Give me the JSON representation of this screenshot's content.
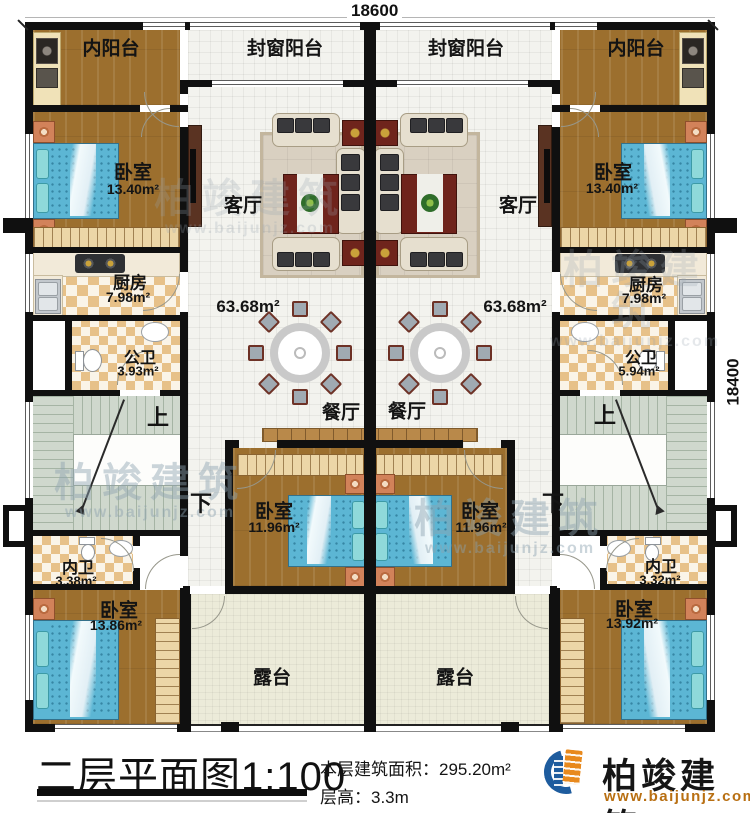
{
  "colors": {
    "wall": "#101010",
    "logo_blue": "#1e5c9e",
    "logo_orange": "#e8891d",
    "url_orange": "#b86f12",
    "bed_blue": "#5cb6d4"
  },
  "dimensions": {
    "top": "18600",
    "right": "18400"
  },
  "left_unit": {
    "inner_balcony": "内阳台",
    "sealed_balcony": "封窗阳台",
    "bedroom_top": {
      "name": "卧室",
      "area": "13.40m²"
    },
    "living": "客厅",
    "kitchen": {
      "name": "厨房",
      "area": "7.98m²"
    },
    "public_bath": {
      "name": "公卫",
      "area": "3.93m²"
    },
    "floor_area": "63.68m²",
    "dining": "餐厅",
    "stairs_up": "上",
    "stairs_down": "下",
    "private_bath": {
      "name": "内卫",
      "area": "3.38m²"
    },
    "bedroom_mid": {
      "name": "卧室",
      "area": "11.96m²"
    },
    "bedroom_bottom": {
      "name": "卧室",
      "area": "13.86m²"
    },
    "terrace": "露台"
  },
  "right_unit": {
    "inner_balcony": "内阳台",
    "sealed_balcony": "封窗阳台",
    "bedroom_top": {
      "name": "卧室",
      "area": "13.40m²"
    },
    "living": "客厅",
    "kitchen": {
      "name": "厨房",
      "area": "7.98m²"
    },
    "public_bath": {
      "name": "公卫",
      "area": "5.94m²"
    },
    "floor_area": "63.68m²",
    "dining": "餐厅",
    "stairs_up": "上",
    "stairs_down": "下",
    "private_bath": {
      "name": "内卫",
      "area": "3.32m²"
    },
    "bedroom_mid": {
      "name": "卧室",
      "area": "11.96m²"
    },
    "bedroom_bottom": {
      "name": "卧室",
      "area": "13.92m²"
    },
    "terrace": "露台"
  },
  "titleblock": {
    "title": "二层平面图1:100",
    "building_area": "本层建筑面积：295.20m²",
    "floor_height": "层高：3.3m",
    "brand": "柏竣建筑",
    "website": "www.baijunjz.com"
  },
  "watermark": {
    "brand": "柏竣建筑",
    "website": "www.baijunjz.com"
  }
}
